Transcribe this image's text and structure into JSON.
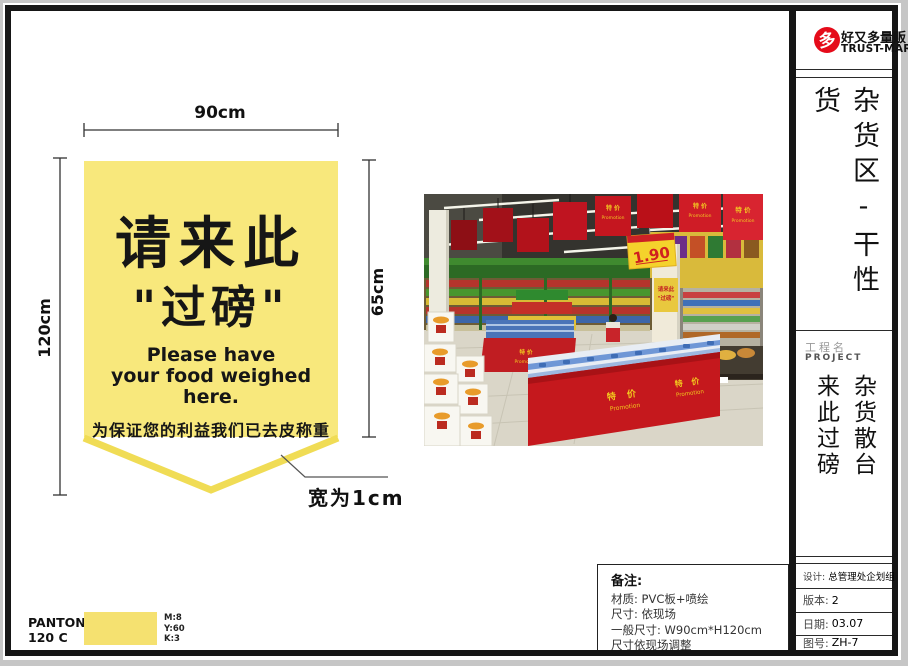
{
  "brand": {
    "logo_char": "多",
    "name_cn": "好又多量贩",
    "name_en": "TRUST-MART",
    "logo_color": "#E50B1A"
  },
  "sidebar": {
    "section_title": "杂货区-干性货",
    "project_label_cn": "工程名",
    "project_label_en": "PROJECT",
    "project_col_left": "来此过磅",
    "project_col_right": "杂货散台",
    "meta": [
      {
        "label": "设计:",
        "value": "总管理处企划组"
      },
      {
        "label": "版本:",
        "value": "2"
      },
      {
        "label": "日期:",
        "value": "03.07"
      },
      {
        "label": "图号:",
        "value": "ZH-7"
      }
    ]
  },
  "design": {
    "dim_width": "90cm",
    "dim_height_full": "120cm",
    "dim_height_body": "65cm",
    "band_note": "宽为1cm",
    "banner": {
      "line1_cn": "请来此",
      "line2_cn": "\"过磅\"",
      "line3_en": "Please have",
      "line4_en": "your food weighed here.",
      "line5_cn": "为保证您的利益我们已去皮称重",
      "fill_color": "#F8E87C",
      "band_color": "#F0DC55"
    }
  },
  "photo": {
    "promo_cn": "特 价",
    "promo_en": "Promotion",
    "price": "1.90",
    "column_sign_line1": "请来此",
    "column_sign_line2": "\"过磅\"",
    "banner_red": "#C5161F"
  },
  "notes": {
    "title": "备注:",
    "line1": "材质: PVC板+喷绘",
    "line2": "尺寸: 依现场",
    "line3": "一般尺寸: W90cm*H120cm",
    "line4": "尺寸依现场调整"
  },
  "pantone": {
    "name": "PANTONE",
    "code": "120 C",
    "swatch_color": "#F5E170",
    "m": "M:8",
    "y": "Y:60",
    "k": "K:3"
  }
}
